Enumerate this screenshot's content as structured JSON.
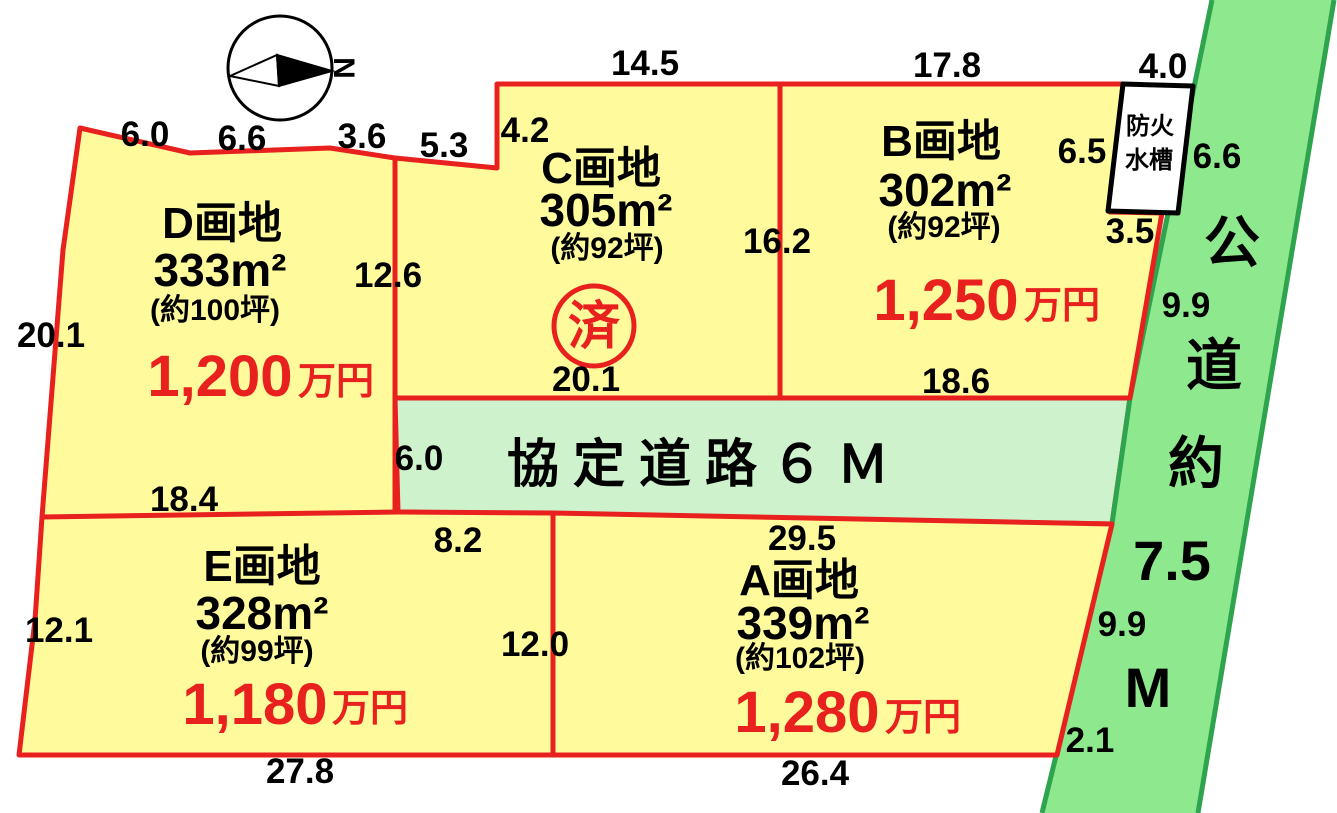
{
  "compass": {
    "north": "N"
  },
  "parcels": {
    "d": {
      "name": "D画地",
      "area": "333m²",
      "tsubo": "(約100坪)",
      "price": "1,200",
      "unit": "万円"
    },
    "c": {
      "name": "C画地",
      "area": "305m²",
      "tsubo": "(約92坪)",
      "stamp": "済"
    },
    "b": {
      "name": "B画地",
      "area": "302m²",
      "tsubo": "(約92坪)",
      "price": "1,250",
      "unit": "万円"
    },
    "e": {
      "name": "E画地",
      "area": "328m²",
      "tsubo": "(約99坪)",
      "price": "1,180",
      "unit": "万円"
    },
    "a": {
      "name": "A画地",
      "area": "339m²",
      "tsubo": "(約102坪)",
      "price": "1,280",
      "unit": "万円"
    }
  },
  "roads": {
    "agreement_road_label": "協定道路６Ｍ",
    "agreement_road_width": "6.0",
    "public_road_chars": {
      "c1": "公",
      "c2": "道",
      "c3": "約",
      "c4": "7.5",
      "c5": "M"
    }
  },
  "structures": {
    "fire_tank_line1": "防火",
    "fire_tank_line2": "水槽"
  },
  "dimensions": {
    "d_top_1": "6.0",
    "d_top_2": "6.6",
    "d_top_3": "3.6",
    "c_step": "5.3",
    "c_left_top": "4.2",
    "c_top": "14.5",
    "b_top": "17.8",
    "tank_top": "4.0",
    "tank_left": "6.5",
    "tank_right": "6.6",
    "tank_bottom": "3.5",
    "cb_boundary": "16.2",
    "dc_boundary": "12.6",
    "b_road": "9.9",
    "d_left": "20.1",
    "c_bottom": "20.1",
    "b_bottom": "18.6",
    "d_bottom": "18.4",
    "e_top_road": "8.2",
    "a_top": "29.5",
    "e_left": "12.1",
    "ea_boundary": "12.0",
    "a_road": "9.9",
    "e_bottom": "27.8",
    "a_bottom": "26.4",
    "a_corner": "2.1"
  },
  "colors": {
    "parcel_fill": "#fffb9d",
    "agreement_road_fill": "#cdf2cc",
    "public_road_fill": "#8ee98e",
    "public_road_edge": "#2fa44e",
    "boundary_red": "#e8201e",
    "price_red": "#e8201e"
  }
}
